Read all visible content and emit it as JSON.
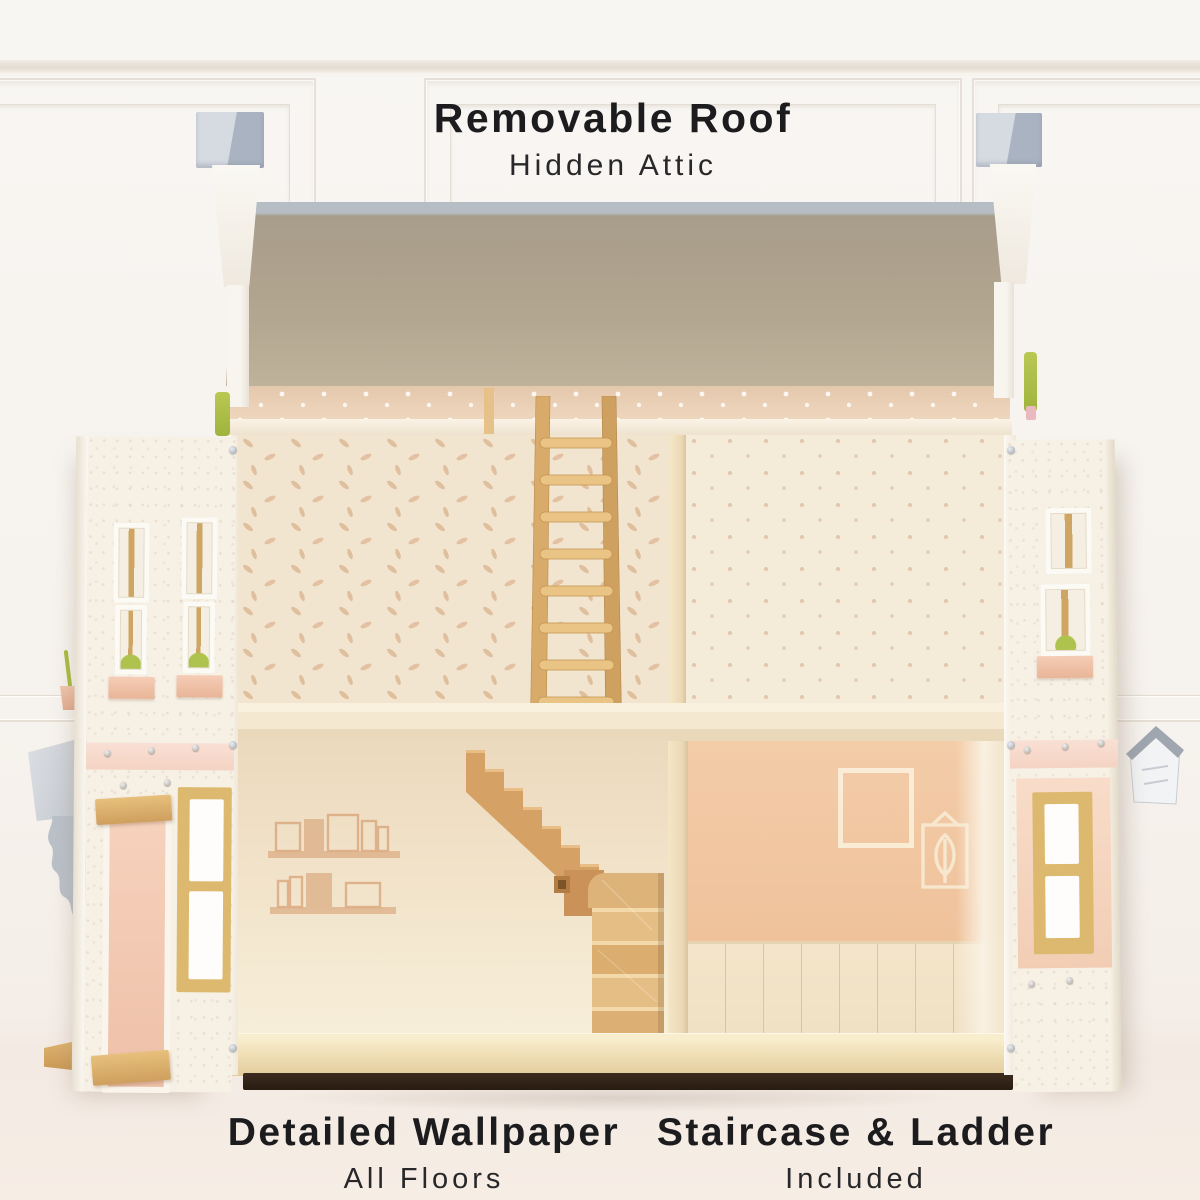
{
  "annotations": {
    "top": {
      "title": "Removable Roof",
      "subtitle": "Hidden Attic"
    },
    "bottom_left": {
      "title": "Detailed Wallpaper",
      "subtitle": "All Floors"
    },
    "bottom_right": {
      "title": "Staircase & Ladder",
      "subtitle": "Included"
    }
  },
  "colors": {
    "text": "#1c1c1e",
    "background_wall": "#f6f2ed",
    "roof_underside": "#b3a690",
    "roof_edge_gray": "#b7bdc5",
    "attic_wall": "#e9cfb6",
    "wallpaper_cream": "#f2e5d0",
    "wallpaper_peach": "#f2c9a5",
    "wood_light": "#e2ba80",
    "wood_mid": "#d39e62",
    "facade_cream": "#f6f0e5",
    "planter_pink": "#f2c5ad",
    "door_pink": "#f4cab4",
    "chimney_gray": "#c3cad6",
    "plant_green": "#afc24a"
  }
}
